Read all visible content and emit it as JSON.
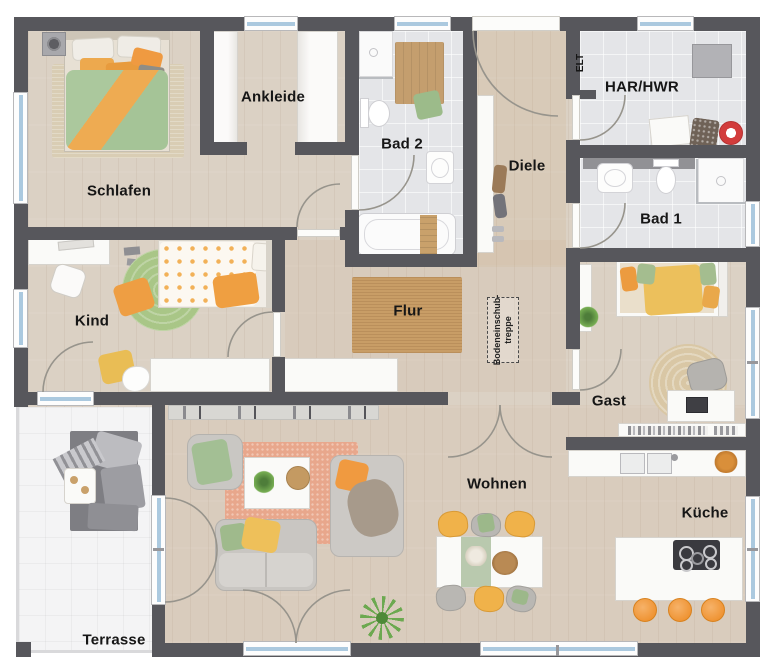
{
  "rooms": {
    "schlafen": {
      "label": "Schlafen"
    },
    "ankleide": {
      "label": "Ankleide"
    },
    "bad2": {
      "label": "Bad 2"
    },
    "diele": {
      "label": "Diele"
    },
    "elt": {
      "label": "ELT"
    },
    "har_hwr": {
      "label": "HAR/HWR"
    },
    "bad1": {
      "label": "Bad 1"
    },
    "kind": {
      "label": "Kind"
    },
    "flur": {
      "label": "Flur"
    },
    "gast": {
      "label": "Gast"
    },
    "wohnen": {
      "label": "Wohnen"
    },
    "kueche": {
      "label": "Küche"
    },
    "terrasse": {
      "label": "Terrasse"
    },
    "bodeneinschubtreppe": {
      "line1": "Bodeneinschub-",
      "line2": "treppe"
    }
  },
  "colors": {
    "wall": "#57575c",
    "wood_floor": "#dbd1c4",
    "tile_floor": "#e4e5e8",
    "terrace_floor": "#f4f4f5",
    "window_glass": "#abc9df",
    "door_arc": "#97948c",
    "accent_orange": "#ef9f3e",
    "accent_yellow": "#ecc05c",
    "accent_green": "#a5c497",
    "rug_salmon": "#e8a78c",
    "rug_jute": "#c89d66",
    "rug_green": "#a9c687",
    "stool_orange": "#f0993c"
  }
}
